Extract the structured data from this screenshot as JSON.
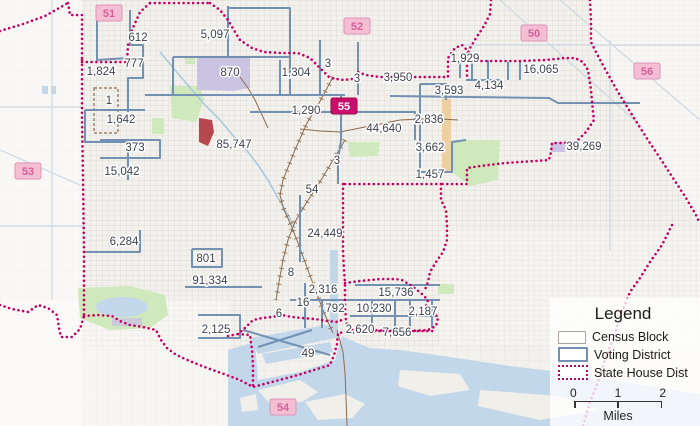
{
  "map": {
    "census_labels": [
      {
        "text": "612",
        "x": 138,
        "y": 41
      },
      {
        "text": "5,097",
        "x": 215,
        "y": 38
      },
      {
        "text": "777",
        "x": 134,
        "y": 67
      },
      {
        "text": "1,824",
        "x": 101,
        "y": 75
      },
      {
        "text": "870",
        "x": 230,
        "y": 76
      },
      {
        "text": "1,304",
        "x": 296,
        "y": 76
      },
      {
        "text": "3",
        "x": 328,
        "y": 67,
        "size": 10
      },
      {
        "text": "1,929",
        "x": 465,
        "y": 62
      },
      {
        "text": "4,134",
        "x": 489,
        "y": 89
      },
      {
        "text": "16,065",
        "x": 541,
        "y": 73
      },
      {
        "text": "3",
        "x": 357,
        "y": 82,
        "size": 10
      },
      {
        "text": "3,950",
        "x": 398,
        "y": 81
      },
      {
        "text": "3,593",
        "x": 449,
        "y": 94
      },
      {
        "text": "1,642",
        "x": 121,
        "y": 123
      },
      {
        "text": "1",
        "x": 109,
        "y": 104,
        "size": 10
      },
      {
        "text": "1,290",
        "x": 306,
        "y": 114
      },
      {
        "text": "44,640",
        "x": 384,
        "y": 132,
        "size": 13
      },
      {
        "text": "2,836",
        "x": 429,
        "y": 123
      },
      {
        "text": "373",
        "x": 135,
        "y": 151
      },
      {
        "text": "85,747",
        "x": 234,
        "y": 148,
        "size": 13
      },
      {
        "text": "3,662",
        "x": 430,
        "y": 151
      },
      {
        "text": "39,269",
        "x": 584,
        "y": 150
      },
      {
        "text": "15,042",
        "x": 122,
        "y": 175
      },
      {
        "text": "1,457",
        "x": 430,
        "y": 178
      },
      {
        "text": "3",
        "x": 337,
        "y": 164,
        "size": 10
      },
      {
        "text": "54",
        "x": 312,
        "y": 193
      },
      {
        "text": "6,284",
        "x": 124,
        "y": 245
      },
      {
        "text": "24,449",
        "x": 325,
        "y": 237,
        "size": 13
      },
      {
        "text": "801",
        "x": 206,
        "y": 262
      },
      {
        "text": "8",
        "x": 291,
        "y": 276
      },
      {
        "text": "91,334",
        "x": 210,
        "y": 284,
        "size": 13
      },
      {
        "text": "2,316",
        "x": 323,
        "y": 293
      },
      {
        "text": "15,736",
        "x": 396,
        "y": 296
      },
      {
        "text": "16",
        "x": 303,
        "y": 306
      },
      {
        "text": "6",
        "x": 279,
        "y": 317,
        "size": 10
      },
      {
        "text": "792",
        "x": 335,
        "y": 312
      },
      {
        "text": "10,230",
        "x": 374,
        "y": 312
      },
      {
        "text": "2,187",
        "x": 423,
        "y": 315
      },
      {
        "text": "2,620",
        "x": 360,
        "y": 333
      },
      {
        "text": "7,656",
        "x": 397,
        "y": 336
      },
      {
        "text": "2,125",
        "x": 216,
        "y": 333
      },
      {
        "text": "49",
        "x": 308,
        "y": 357
      }
    ],
    "district_badges": [
      {
        "number": "51",
        "x": 109,
        "y": 13,
        "selected": false
      },
      {
        "number": "52",
        "x": 357,
        "y": 26,
        "selected": false
      },
      {
        "number": "50",
        "x": 534,
        "y": 33,
        "selected": false
      },
      {
        "number": "56",
        "x": 647,
        "y": 71,
        "selected": false
      },
      {
        "number": "53",
        "x": 28,
        "y": 171,
        "selected": false
      },
      {
        "number": "55",
        "x": 344,
        "y": 106,
        "selected": true
      },
      {
        "number": "54",
        "x": 283,
        "y": 407,
        "selected": false
      }
    ]
  },
  "legend": {
    "title": "Legend",
    "items": [
      {
        "label": "Census Block",
        "type": "census"
      },
      {
        "label": "Voting District",
        "type": "voting"
      },
      {
        "label": "State House Dist",
        "type": "house"
      }
    ],
    "scale": {
      "ticks": [
        "0",
        "1",
        "2"
      ],
      "unit": "Miles"
    }
  },
  "colors": {
    "state_house_boundary": "#c50063",
    "voting_district_line": "#7291b3",
    "district_badge_bg": "#f4bed3",
    "district_badge_text": "#d55f9a",
    "selected_badge_bg": "#ca0e6c",
    "selected_badge_text": "#ffffff",
    "census_label_text": "#3e424d",
    "water": "#c3d7eb",
    "park": "#cfe8bc",
    "railroad": "#8e6b4d"
  }
}
